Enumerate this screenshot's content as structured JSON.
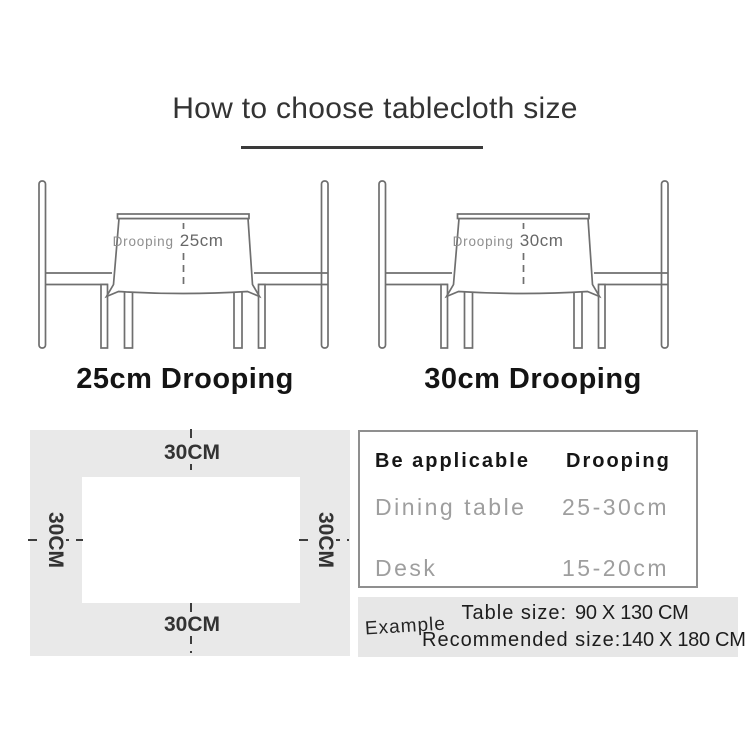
{
  "title": "How to choose tablecloth size",
  "diagrams": [
    {
      "drooping_label": "Drooping",
      "value": "25cm",
      "caption": "25cm Drooping"
    },
    {
      "drooping_label": "Drooping",
      "value": "30cm",
      "caption": "30cm Drooping"
    }
  ],
  "size_diagram": {
    "top_label": "30CM",
    "bottom_label": "30CM",
    "left_label": "30CM",
    "right_label": "30CM"
  },
  "spec_table": {
    "headers": [
      "Be applicable",
      "Drooping"
    ],
    "rows": [
      [
        "Dining table",
        "25-30cm"
      ],
      [
        "Desk",
        "15-20cm"
      ]
    ]
  },
  "example": {
    "label": "Example",
    "table_size_label": "Table size:",
    "table_size_value": "90 X 130 CM",
    "recommended_label": "Recommended size:",
    "recommended_value": "140 X 180 CM"
  },
  "colors": {
    "accent_line": "#3a3a3a",
    "line_art": "#6f6f6f",
    "panel_bg": "#e9e9e9",
    "example_bg": "#e7e7e7",
    "table_border": "#8f8f8f",
    "muted_text": "#9e9e9e"
  }
}
